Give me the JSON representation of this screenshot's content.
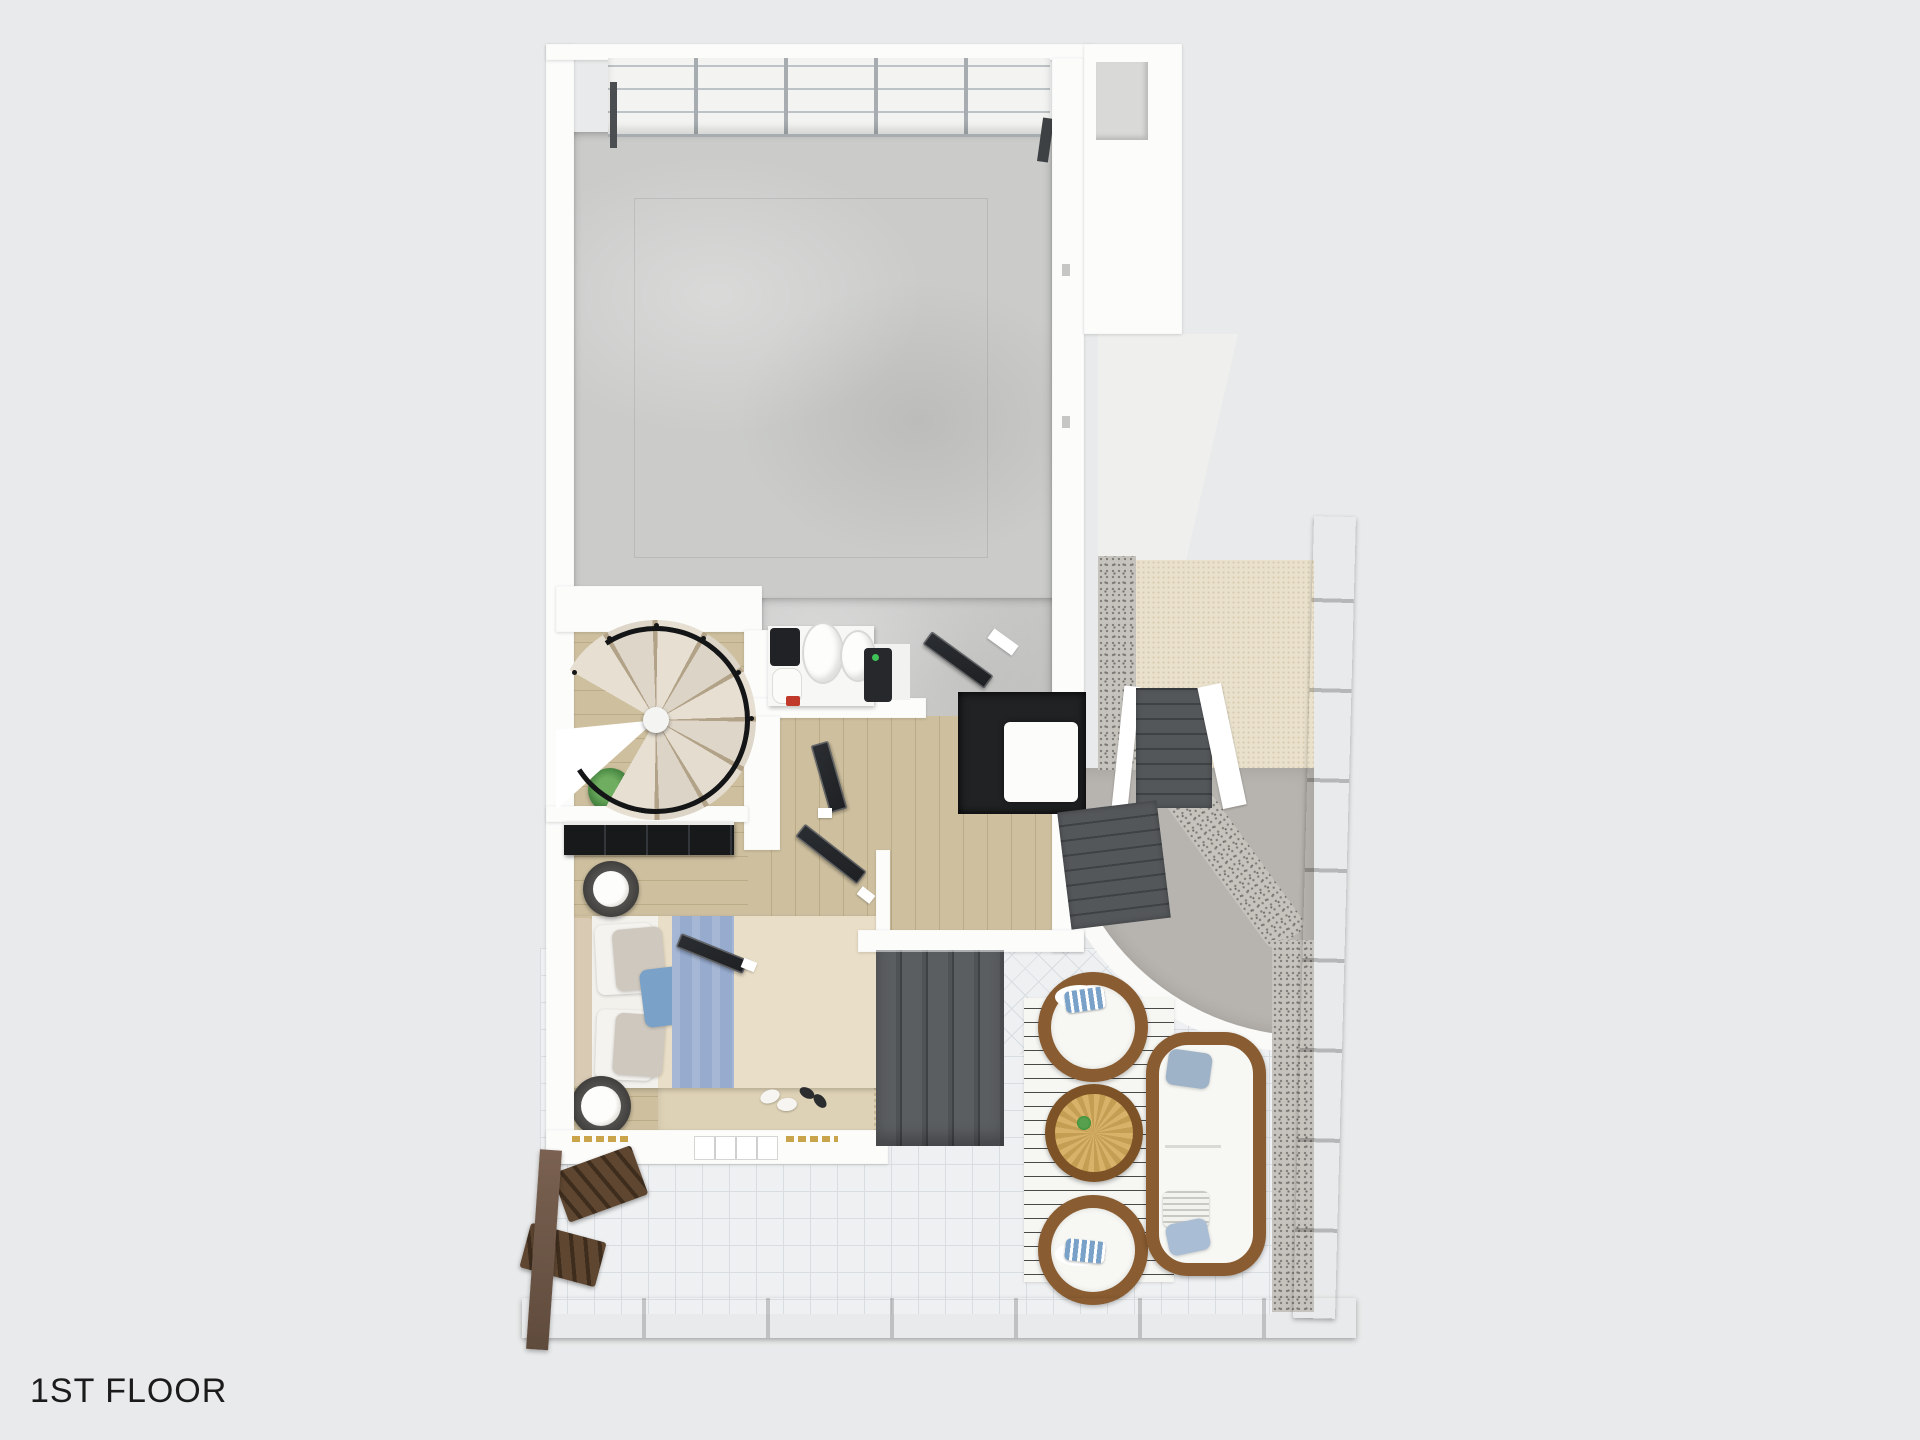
{
  "page": {
    "floor_label": "1ST FLOOR"
  },
  "palette": {
    "background": "#e8eaeb",
    "wall": "#fcfcfb",
    "concrete": "#cbccca",
    "garage_panel": "#f3f3f1",
    "garage_rail": "#bcc2c5",
    "garage_divider": "#a6acaf",
    "wood": "#cec09f",
    "wood_line": "#bcab87",
    "stair_edge": "#b2a287",
    "railing": "#141517",
    "door": "#1e2023",
    "wardrobe": "#17191b",
    "dark_stair": "#54575a",
    "dark_stair_edge": "#3f4245",
    "tile": "#eef0f2",
    "tile_line": "#d8dde1",
    "rug_patio": "#f6f6f3",
    "rattan": "#8a5c31",
    "rattan_dark": "#7c5226",
    "cushion": "#f7f7f4",
    "table_top": "#d8b269",
    "table_spoke": "#c49e52",
    "plant_green": "#3f7d3b",
    "gravel": "#c6c3bd",
    "gravel_dot": "#807e79",
    "path": "#b7b3ae",
    "curb": "#fafaf8",
    "cream": "#e9e1cc",
    "cream_dot": "#d6cbae",
    "fence": "#7a6151",
    "fence_dark": "#5f4b3c",
    "ladder": "#5e4631",
    "bed_duvet": "#e9dec7",
    "bed_sheet": "#f3f1ec",
    "bed_runner": "#97abce",
    "pillow_gray": "#cfc8be",
    "pillow_accent": "#7aa2c8",
    "headboard": "#d8cab3",
    "rug_bed": "#ded2b6",
    "alcove": "#202224",
    "driveway": "#efefed",
    "niche": "#d9d9d7",
    "label": "#1b1b1b"
  },
  "objects": {
    "rooms": [
      "garage",
      "utility-nook",
      "spiral-stair-room",
      "bedroom",
      "hallway",
      "patio",
      "side-yard"
    ],
    "items": [
      "garage-door",
      "water-heater-tanks",
      "spiral-staircase",
      "potted-plant",
      "wardrobe",
      "double-bed",
      "side-tables",
      "slippers",
      "open-doors",
      "interior-stairs",
      "exterior-stairs",
      "striped-outdoor-rug",
      "rattan-chairs",
      "rattan-round-table",
      "rattan-sofa",
      "gravel-path",
      "concrete-path",
      "wood-fence",
      "wood-ladders"
    ]
  }
}
